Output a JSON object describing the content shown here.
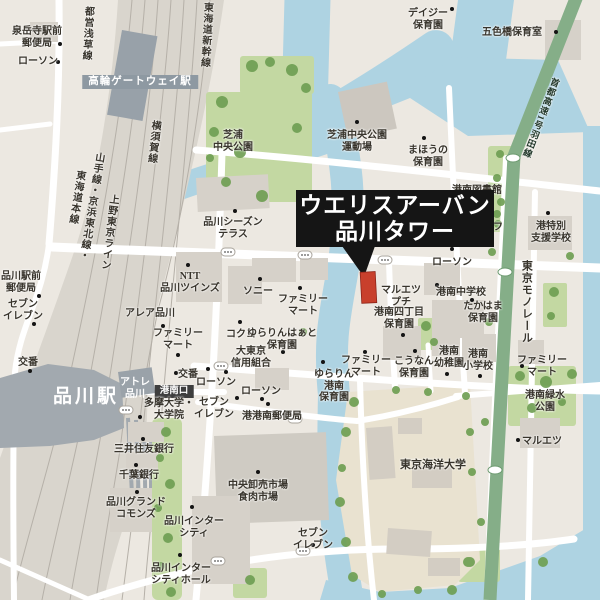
{
  "callout": {
    "line1": "ウエリスアーバン",
    "line2": "品川タワー"
  },
  "colors": {
    "land": "#ece8e1",
    "water": "#aed3e2",
    "park": "#c3d8a2",
    "tree": "#6f9f53",
    "road": "#ffffff",
    "rail_corridor": "#d9d5cd",
    "station_dark": "#a2a9af",
    "monorail_green": "#85ae88",
    "callout_bg": "#151515",
    "callout_text": "#ffffff",
    "featured_building_red": "#c8402c",
    "label_text": "#38342c",
    "gateway_box": "#8e99a2",
    "konan_exit_box": "#3e3e3e"
  },
  "labels": [
    {
      "id": "sengakuji-post",
      "text": "泉岳寺駅前\n郵便局",
      "x": 37,
      "y": 26,
      "dot": [
        60,
        44
      ]
    },
    {
      "id": "lawson-nw",
      "text": "ローソン",
      "x": 38,
      "y": 56,
      "dot": [
        58,
        62
      ]
    },
    {
      "id": "takanawa-gateway-station",
      "text": "高輪ゲートウェイ駅",
      "x": 140,
      "y": 75,
      "style": "box-gray"
    },
    {
      "id": "toei-asakusa-line",
      "text": "都営浅草線",
      "x": 88,
      "y": 6,
      "vertical": true,
      "rotate": 3
    },
    {
      "id": "tokaido-shinkansen",
      "text": "東海道新幹線",
      "x": 207,
      "y": 2,
      "vertical": true,
      "rotate": 3
    },
    {
      "id": "yokosuka-line",
      "text": "横須賀線",
      "x": 155,
      "y": 120,
      "vertical": true,
      "rotate": 6
    },
    {
      "id": "yamanote-keihin-tohoku-line",
      "text": "山手線・京浜東北線・",
      "x": 99,
      "y": 152,
      "vertical": true,
      "rotate": 9
    },
    {
      "id": "tokaido-honsen",
      "text": "東海道本線",
      "x": 80,
      "y": 170,
      "vertical": true,
      "rotate": 9
    },
    {
      "id": "ueno-tokyo-line",
      "text": "上野東京ライン",
      "x": 113,
      "y": 194,
      "vertical": true,
      "rotate": 7
    },
    {
      "id": "shibaura-central-park",
      "text": "芝浦\n中央公園",
      "x": 233,
      "y": 130
    },
    {
      "id": "daisy-nursery",
      "text": "デイジー\n保育園",
      "x": 428,
      "y": 8,
      "dot": [
        452,
        9
      ]
    },
    {
      "id": "goshikibashi-nursery",
      "text": "五色橋保育室",
      "x": 512,
      "y": 27,
      "dot": [
        556,
        32
      ]
    },
    {
      "id": "shuto-expressway-haneda",
      "text": "首都高速1号羽田線",
      "x": 556,
      "y": 78,
      "vertical": true,
      "rotate": 21,
      "size": 9,
      "style": "green-road"
    },
    {
      "id": "shibaura-park-sports-ground",
      "text": "芝浦中央公園\n運動場",
      "x": 357,
      "y": 130,
      "dot": [
        357,
        122
      ]
    },
    {
      "id": "mahou-nursery",
      "text": "まほうの\n保育園",
      "x": 428,
      "y": 145,
      "dot": [
        424,
        138
      ]
    },
    {
      "id": "konan-library",
      "text": "港南図書館",
      "x": 477,
      "y": 185,
      "dot": [
        477,
        201
      ]
    },
    {
      "id": "three-f",
      "text": "スリーエフ",
      "x": 478,
      "y": 222,
      "dot": [
        477,
        214
      ]
    },
    {
      "id": "minato-special-support-school",
      "text": "港特別\n支援学校",
      "x": 551,
      "y": 221,
      "dot": [
        548,
        213
      ]
    },
    {
      "id": "lawson-east",
      "text": "ローソン",
      "x": 452,
      "y": 257,
      "dot": [
        452,
        249
      ]
    },
    {
      "id": "tokyo-monorail",
      "text": "東京モノレール",
      "x": 526,
      "y": 260,
      "vertical": true,
      "size": 11
    },
    {
      "id": "konan-junior-high",
      "text": "港南中学校",
      "x": 461,
      "y": 287,
      "dot": [
        472,
        300
      ]
    },
    {
      "id": "takahama-nursery",
      "text": "たかはま\n保育園",
      "x": 483,
      "y": 301
    },
    {
      "id": "maruetsu-petit",
      "text": "マルエツ\nプチ",
      "x": 401,
      "y": 285,
      "dot": [
        437,
        285
      ]
    },
    {
      "id": "konan-4chome-nursery",
      "text": "港南四丁目\n保育園",
      "x": 399,
      "y": 307,
      "dot": [
        403,
        335
      ]
    },
    {
      "id": "sony",
      "text": "ソニー",
      "x": 258,
      "y": 286,
      "dot": [
        260,
        279
      ]
    },
    {
      "id": "familymart-sony",
      "text": "ファミリー\nマート",
      "x": 303,
      "y": 294,
      "dot": [
        300,
        288
      ]
    },
    {
      "id": "shinagawa-season-terrace",
      "text": "品川シーズン\nテラス",
      "x": 233,
      "y": 217,
      "dot": [
        235,
        211
      ]
    },
    {
      "id": "ntt-shinagawa-twins",
      "text": "NTT\n品川ツインズ",
      "x": 190,
      "y": 271,
      "dot": [
        188,
        265
      ]
    },
    {
      "id": "area-shinagawa",
      "text": "アレア品川",
      "x": 150,
      "y": 308,
      "dot": [
        163,
        326
      ]
    },
    {
      "id": "familymart-area",
      "text": "ファミリー\nマート",
      "x": 178,
      "y": 328,
      "dot": [
        178,
        355
      ]
    },
    {
      "id": "kokuyo",
      "text": "コクヨ",
      "x": 241,
      "y": 329,
      "dot": [
        240,
        322
      ]
    },
    {
      "id": "yurarin-heart-nursery",
      "text": "ゆらりんはぁと\n保育園",
      "x": 282,
      "y": 328,
      "dot": [
        283,
        352
      ]
    },
    {
      "id": "daitokyo-shinkumi",
      "text": "大東京\n信用組合",
      "x": 251,
      "y": 346,
      "dot": [
        226,
        372
      ]
    },
    {
      "id": "koban-west",
      "text": "交番",
      "x": 28,
      "y": 357,
      "dot": [
        30,
        371
      ]
    },
    {
      "id": "koban-center",
      "text": "交番",
      "x": 188,
      "y": 369,
      "dot": [
        176,
        373
      ]
    },
    {
      "id": "lawson-center1",
      "text": "ローソン",
      "x": 216,
      "y": 377,
      "dot": [
        208,
        369
      ]
    },
    {
      "id": "konan-exit",
      "text": "港南口",
      "x": 174,
      "y": 385,
      "style": "box-dark"
    },
    {
      "id": "atre-shinagawa",
      "text": "アトレ\n品川",
      "x": 135,
      "y": 377,
      "style": "white"
    },
    {
      "id": "shinagawa-station",
      "text": "品川駅",
      "x": 86,
      "y": 386,
      "style": "white-big"
    },
    {
      "id": "tama-university",
      "text": "多摩大学・\n大学院",
      "x": 169,
      "y": 398,
      "dot": [
        140,
        417
      ]
    },
    {
      "id": "seven-eleven-center",
      "text": "セブン\nイレブン",
      "x": 214,
      "y": 397,
      "dot": [
        237,
        398
      ]
    },
    {
      "id": "lawson-center2",
      "text": "ローソン",
      "x": 261,
      "y": 386,
      "dot": [
        262,
        399
      ]
    },
    {
      "id": "minato-konan-post",
      "text": "港港南郵便局",
      "x": 272,
      "y": 411,
      "dot": [
        268,
        404
      ]
    },
    {
      "id": "seven-eleven-west",
      "text": "セブン\nイレブン",
      "x": 23,
      "y": 299,
      "dot": [
        34,
        324
      ]
    },
    {
      "id": "shinagawa-ekimae-post",
      "text": "品川駅前\n郵便局",
      "x": 21,
      "y": 271,
      "dot": [
        39,
        296
      ]
    },
    {
      "id": "mitsui-sumitomo-bank",
      "text": "三井住友銀行",
      "x": 144,
      "y": 444,
      "dot": [
        143,
        439
      ]
    },
    {
      "id": "chiba-bank",
      "text": "千葉銀行",
      "x": 139,
      "y": 470,
      "dot": [
        136,
        465
      ]
    },
    {
      "id": "shinagawa-grand-commons",
      "text": "品川グランド\nコモンズ",
      "x": 136,
      "y": 497,
      "dot": [
        137,
        492
      ]
    },
    {
      "id": "shinagawa-intercity",
      "text": "品川インター\nシティ",
      "x": 194,
      "y": 516,
      "dot": [
        192,
        507
      ]
    },
    {
      "id": "shinagawa-intercity-hall",
      "text": "品川インター\nシティホール",
      "x": 181,
      "y": 563,
      "dot": [
        180,
        555
      ]
    },
    {
      "id": "chuo-wholesale-meat-market",
      "text": "中央卸売市場\n食肉市場",
      "x": 258,
      "y": 480,
      "dot": [
        258,
        472
      ]
    },
    {
      "id": "seven-eleven-south",
      "text": "セブン\nイレブン",
      "x": 313,
      "y": 528,
      "dot": [
        313,
        545
      ]
    },
    {
      "id": "yurarin-konan-nursery",
      "text": "ゆらりん\n港南\n保育園",
      "x": 334,
      "y": 369,
      "dot": [
        323,
        362
      ]
    },
    {
      "id": "kounan-nursery",
      "text": "こうなん\n保育園",
      "x": 414,
      "y": 356,
      "dot": [
        415,
        351
      ]
    },
    {
      "id": "konan-kindergarten",
      "text": "港南\n幼稚園",
      "x": 449,
      "y": 346,
      "dot": [
        447,
        374
      ]
    },
    {
      "id": "konan-elementary",
      "text": "港南\n小学校",
      "x": 478,
      "y": 349,
      "dot": [
        480,
        376
      ]
    },
    {
      "id": "familymart-konan-west",
      "text": "ファミリー\nマート",
      "x": 366,
      "y": 355,
      "dot": [
        365,
        352
      ]
    },
    {
      "id": "familymart-east",
      "text": "ファミリー\nマート",
      "x": 542,
      "y": 355,
      "dot": [
        522,
        366
      ]
    },
    {
      "id": "konan-ryokusui-park",
      "text": "港南緑水\n公園",
      "x": 545,
      "y": 390
    },
    {
      "id": "maruetsu",
      "text": "マルエツ",
      "x": 542,
      "y": 436,
      "dot": [
        518,
        440
      ]
    },
    {
      "id": "tokyo-kaiyo-university",
      "text": "東京海洋大学",
      "x": 433,
      "y": 459,
      "size": 11
    }
  ]
}
